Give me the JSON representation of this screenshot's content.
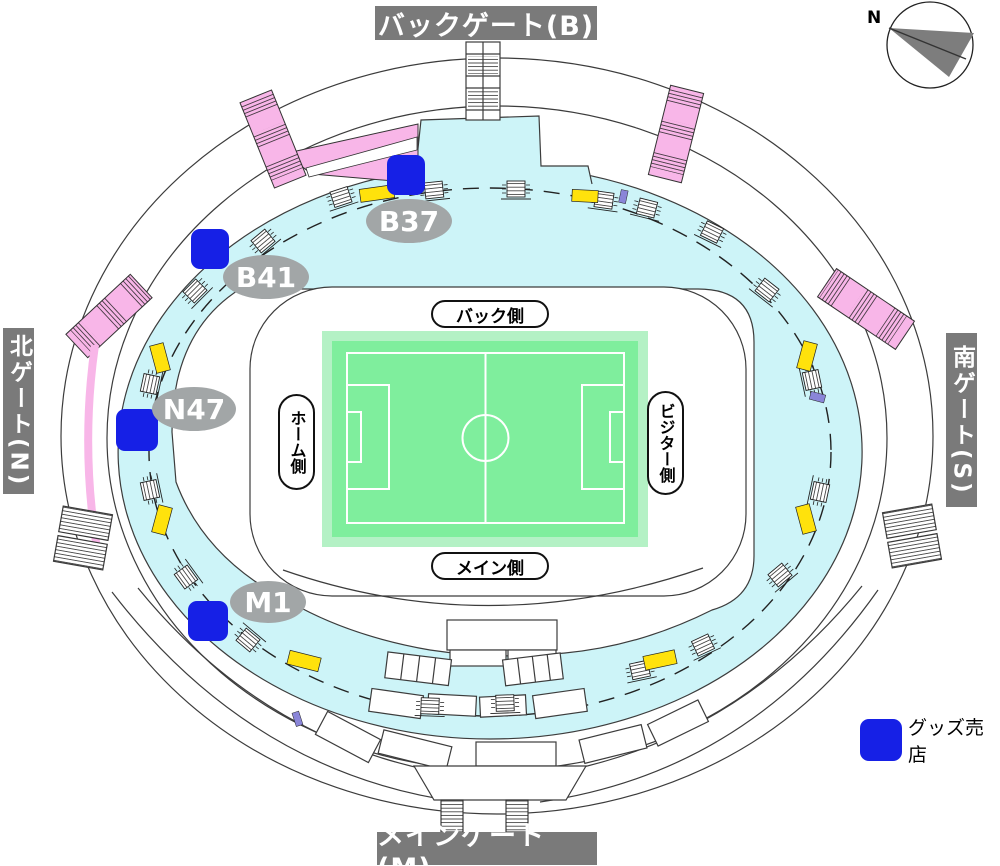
{
  "gates": {
    "back": {
      "label": "バックゲート(B)"
    },
    "main": {
      "label": "メインゲート(M)"
    },
    "north": {
      "label": "北ゲート(N)"
    },
    "south": {
      "label": "南ゲート(S)"
    }
  },
  "compass": {
    "label": "N"
  },
  "stand_labels": {
    "back": "バック側",
    "main": "メイン側",
    "home": "ホーム側",
    "visitor": "ビジター側"
  },
  "goods_shops": {
    "legend_label": "グッズ売店",
    "locations": [
      {
        "label": "B37"
      },
      {
        "label": "B41"
      },
      {
        "label": "N47"
      },
      {
        "label": "M1"
      }
    ]
  },
  "icons": {
    "compass": "compass-icon",
    "stairs": "stairs-icon",
    "goods_shop_marker": "goods-shop-marker"
  },
  "colors": {
    "concourse": "#cdf4f8",
    "pitch": "#7fee9d",
    "pitch_margin": "#b4f1c5",
    "goods_blue": "#1620e6",
    "ramp_pink": "#f8b6e8",
    "kiosk_yellow": "#ffe20c",
    "gate_gray": "#7a7a7a",
    "badge_gray": "#a2a6a7",
    "accent_purple": "#8a85d8",
    "line": "#3c3c3c"
  }
}
